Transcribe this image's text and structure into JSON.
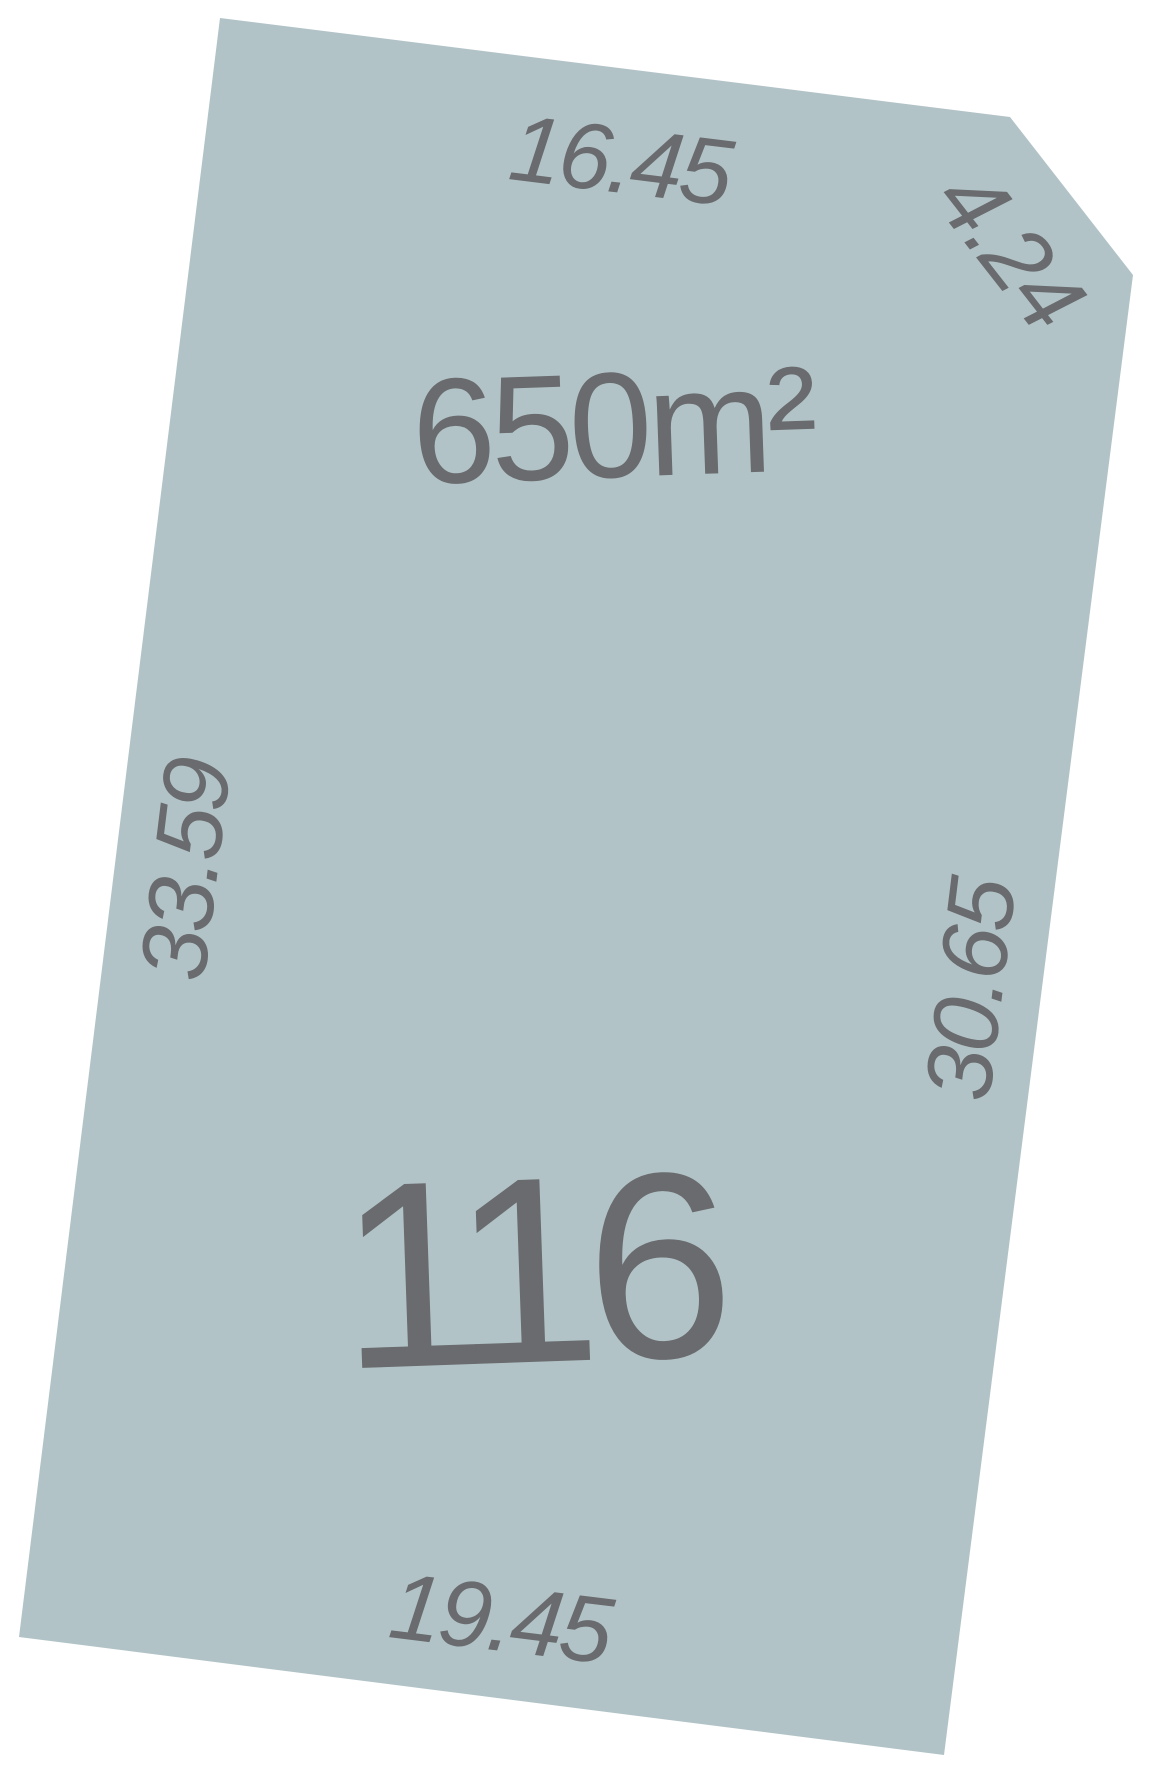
{
  "page": {
    "background_color": "#ffffff"
  },
  "lot": {
    "number": "116",
    "area": "650m²",
    "colors": {
      "fill": "#b1c3c7",
      "label": "#696b6e"
    },
    "dimensions": {
      "top": "16.45",
      "corner": "4.24",
      "right": "30.65",
      "left": "33.59",
      "bottom": "19.45"
    }
  }
}
